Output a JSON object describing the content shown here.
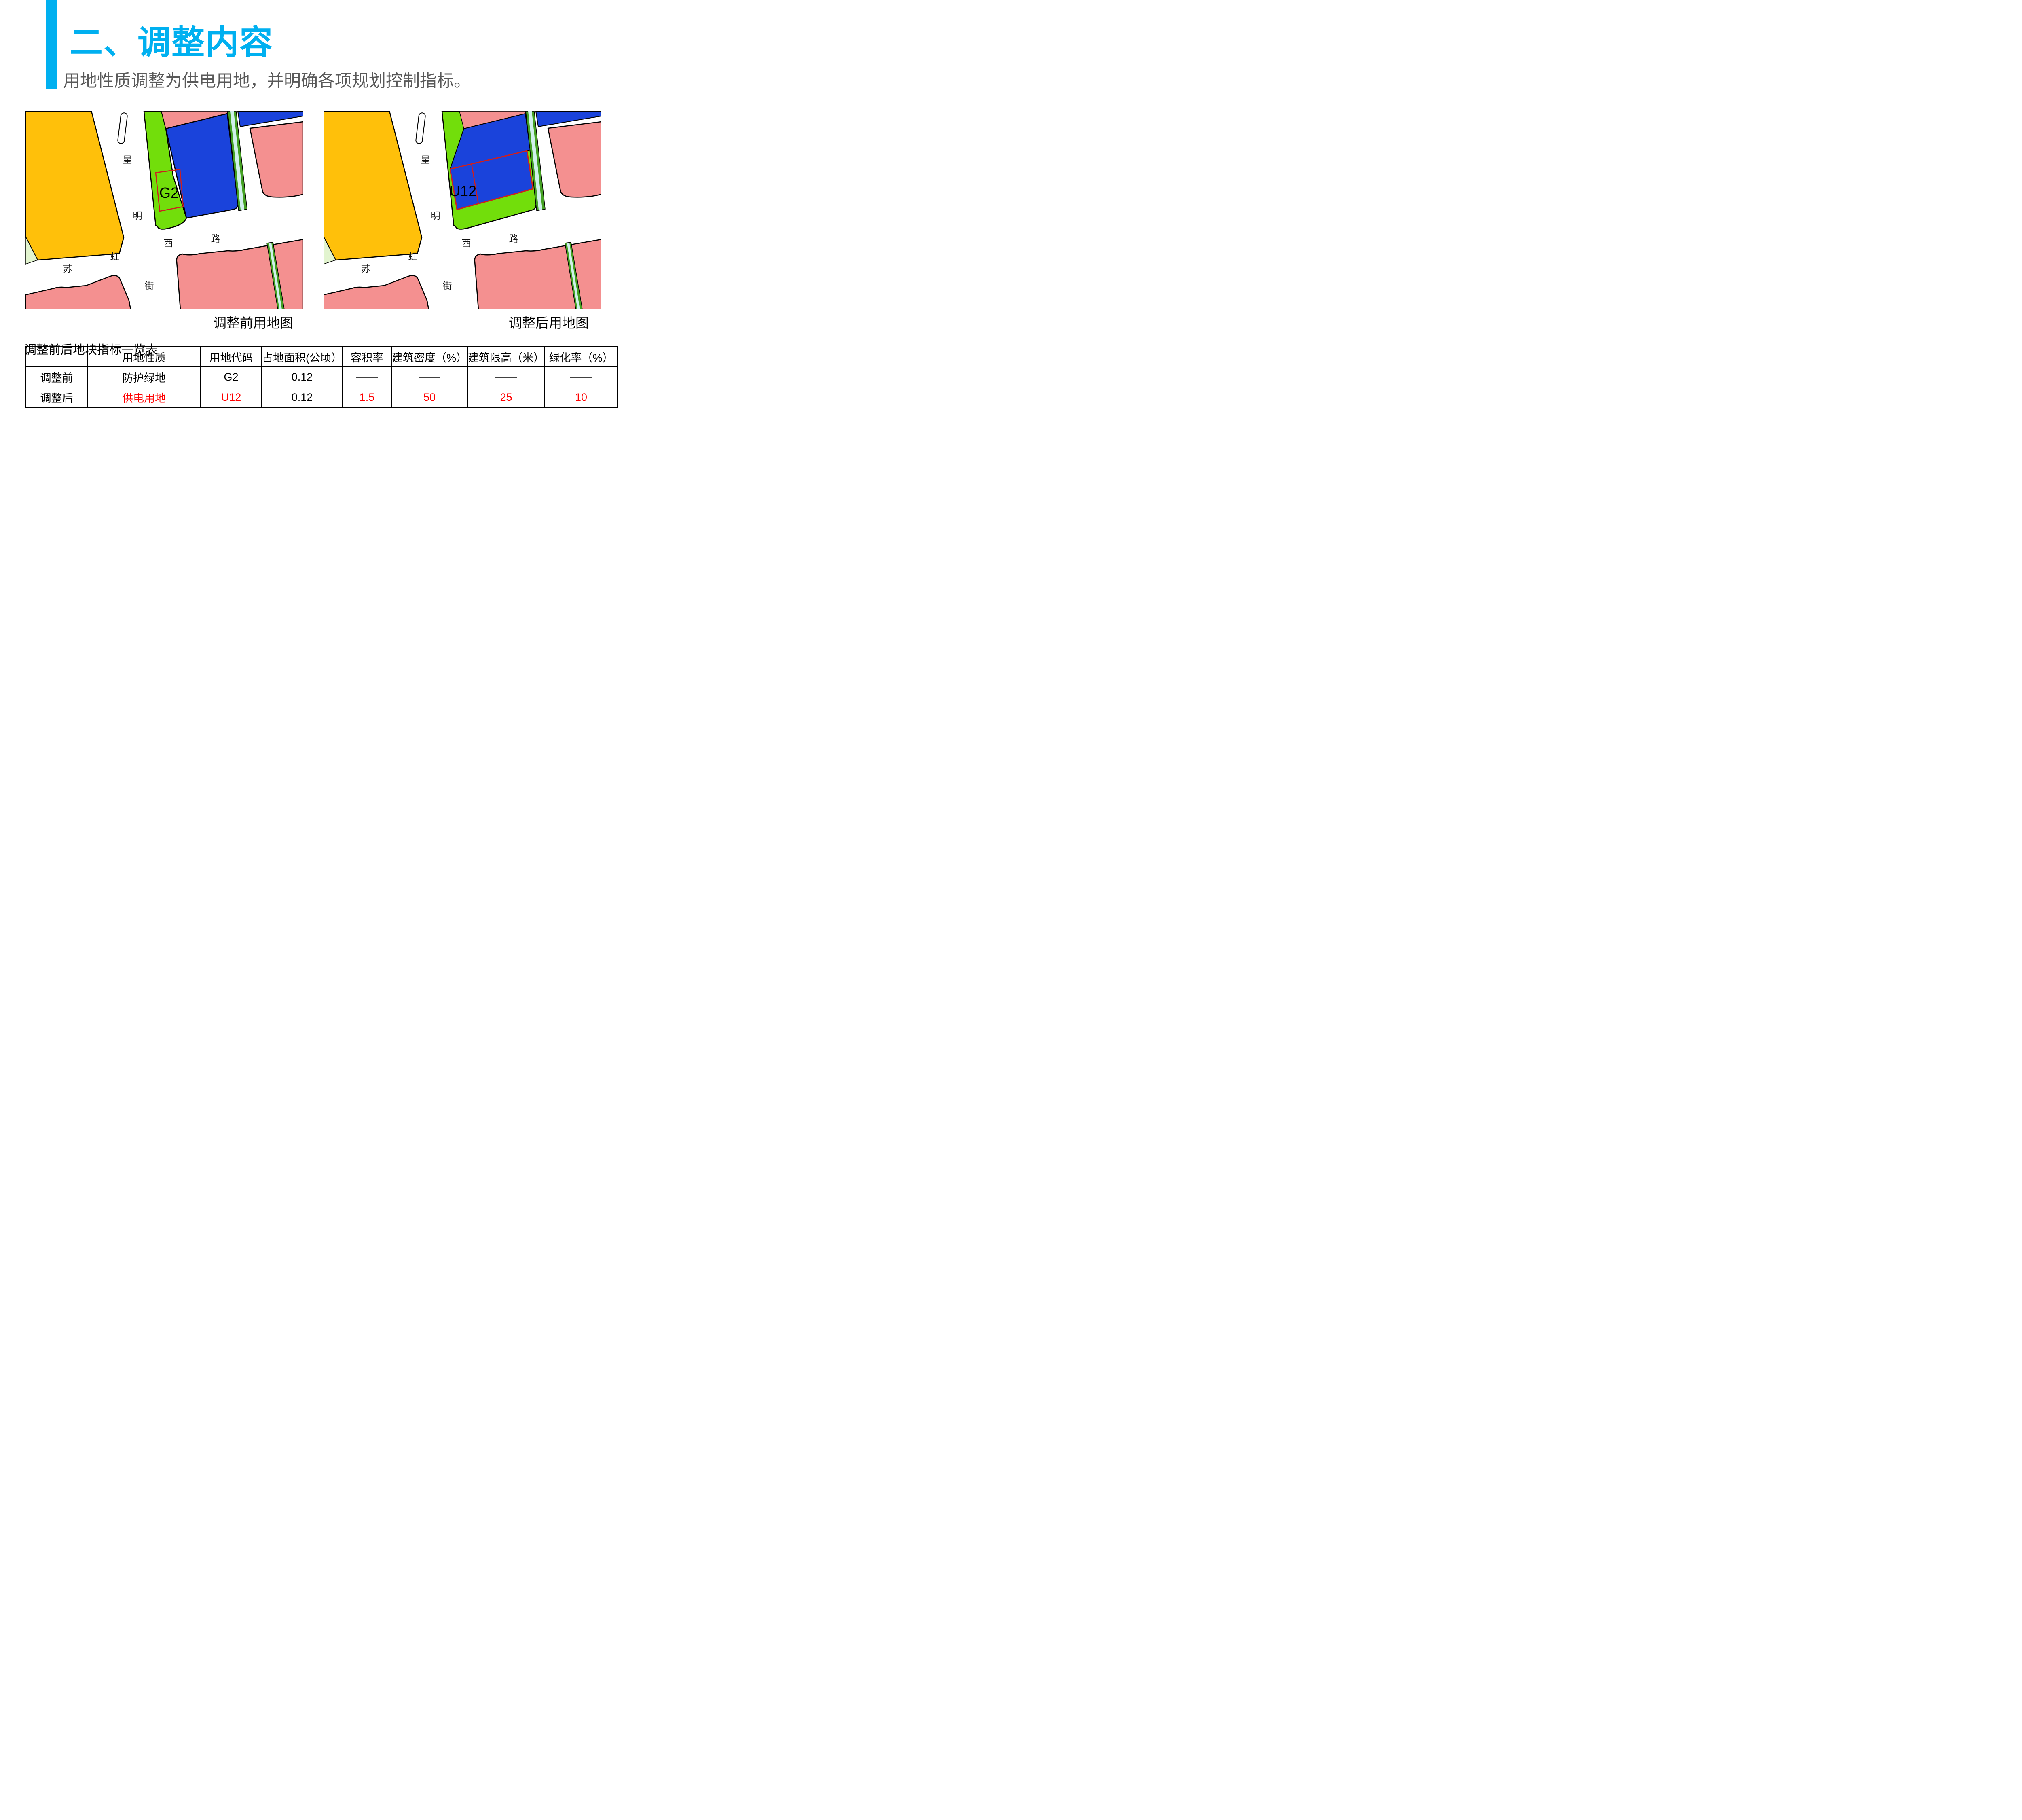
{
  "slide": {
    "title": "二、调整内容",
    "subtitle": "用地性质调整为供电用地，并明确各项规划控制指标。"
  },
  "theme": {
    "accent": "#00B0F0",
    "text-gray": "#595959",
    "table-red": "#FF0000",
    "map-orange": "#FFC00A",
    "map-pale-green": "#E2F4CF",
    "map-green": "#72DE0B",
    "map-blue": "#1A43DB",
    "map-pink": "#F49090",
    "canal-green": "#44A122",
    "canal-cyan": "#CFF0EA",
    "plot-outline-red": "#CC2020"
  },
  "maps": {
    "before": {
      "caption": "调整前用地图",
      "parcel_label": "G2"
    },
    "after": {
      "caption": "调整后用地图",
      "parcel_label": "U12"
    },
    "street_chars": {
      "xing": "星",
      "ming": "明",
      "xi": "西",
      "lu": "路",
      "su": "苏",
      "hong": "虹",
      "jie": "街"
    }
  },
  "table": {
    "title": "调整前后地块指标一览表",
    "headers": [
      "",
      "用地性质",
      "用地代码",
      "占地面积(公顷）",
      "容积率",
      "建筑密度（%）",
      "建筑限高（米）",
      "绿化率（%）"
    ],
    "rows": [
      {
        "label": "调整前",
        "cells": [
          "防护绿地",
          "G2",
          "0.12",
          "——",
          "——",
          "——",
          "——"
        ]
      },
      {
        "label": "调整后",
        "cells": [
          "供电用地",
          "U12",
          "0.12",
          "1.5",
          "50",
          "25",
          "10"
        ]
      }
    ]
  }
}
